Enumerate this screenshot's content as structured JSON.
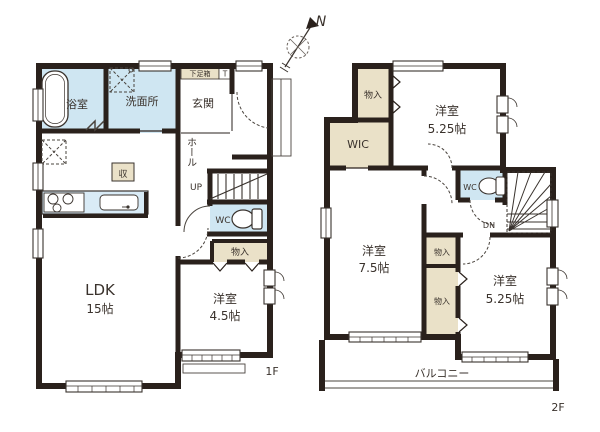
{
  "compass": {
    "north": "N"
  },
  "colors": {
    "wall": "#2a211c",
    "water_room": "#cfe6f2",
    "closet": "#eae1c8",
    "counter": "#d9ebf6",
    "line": "#3a332e",
    "text": "#3a322c",
    "background": "#ffffff"
  },
  "floor1": {
    "label": "1F",
    "rooms": {
      "bath": "浴室",
      "washroom": "洗面所",
      "entrance": "玄関",
      "shoe_box": "下足箱",
      "shoe_box_tag": "T",
      "hall": "ホール",
      "stairs_label": "UP",
      "kitchen_storage": "収",
      "wc": "WC",
      "closet": "物入",
      "ldk": {
        "name": "LDK",
        "size": "15帖"
      },
      "bedroom": {
        "name": "洋室",
        "size": "4.5帖"
      }
    }
  },
  "floor2": {
    "label": "2F",
    "rooms": {
      "closet_top": "物入",
      "bedroom_top": {
        "name": "洋室",
        "size": "5.25帖"
      },
      "wic": "WIC",
      "wc": "WC",
      "stairs_label": "DN",
      "bedroom_left": {
        "name": "洋室",
        "size": "7.5帖"
      },
      "closet_mid": "物入",
      "closet_lower": "物入",
      "bedroom_right": {
        "name": "洋室",
        "size": "5.25帖"
      },
      "balcony": "バルコニー"
    }
  }
}
